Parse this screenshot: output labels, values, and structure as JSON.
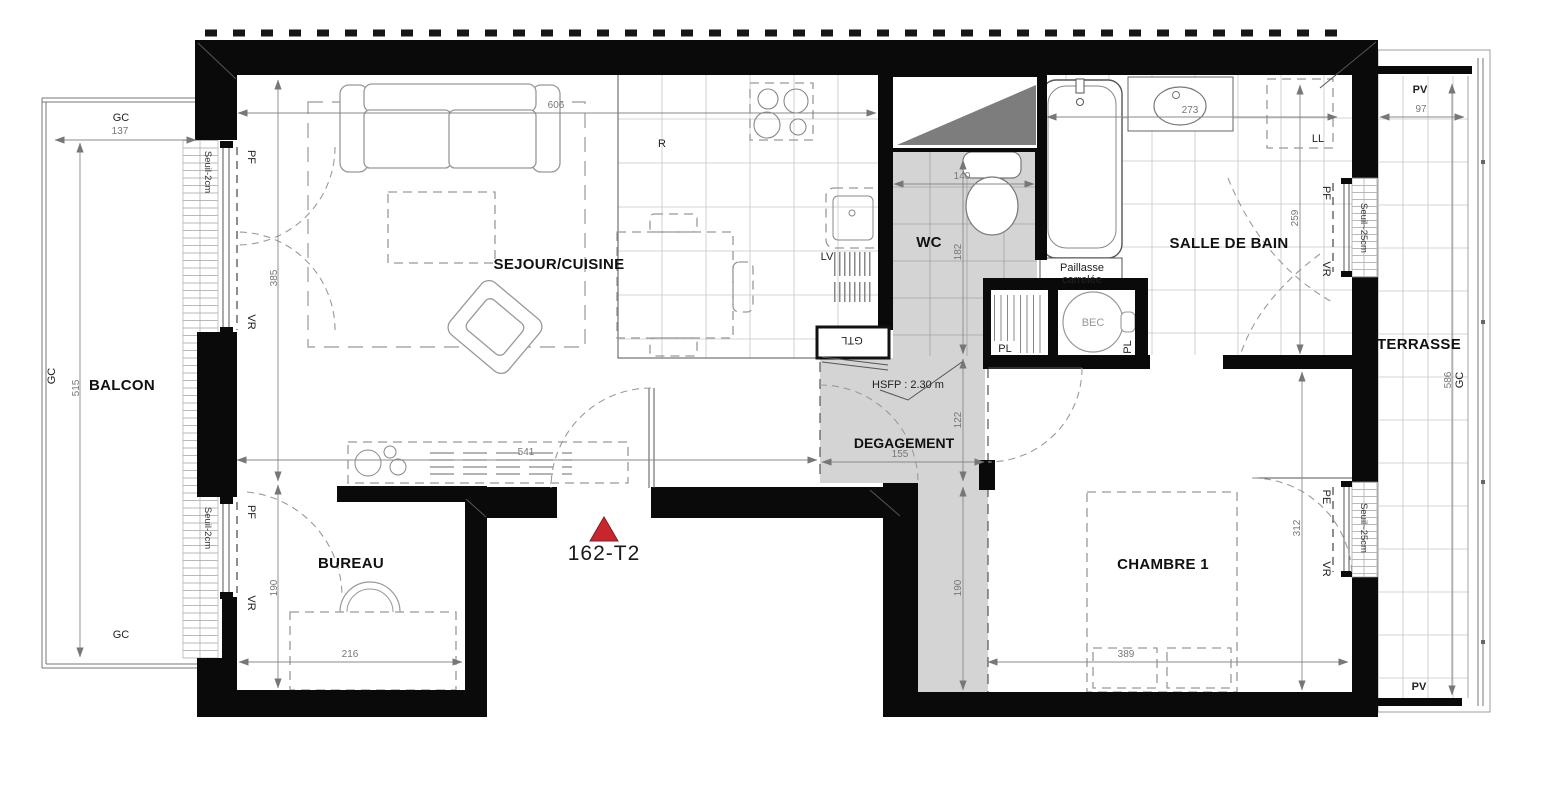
{
  "plan": {
    "unit": "162-T2",
    "rooms": {
      "balcon": "BALCON",
      "sejour": "SEJOUR/CUISINE",
      "bureau": "BUREAU",
      "wc": "WC",
      "bain": "SALLE DE BAIN",
      "terrasse": "TERRASSE",
      "degagement": "DEGAGEMENT",
      "chambre": "CHAMBRE 1"
    },
    "equipment": {
      "gtl": "GTL",
      "bec": "BEC",
      "lv": "LV",
      "ll": "LL",
      "r": "R",
      "pl": "PL",
      "paillasse1": "Paillasse",
      "paillasse2": "carrelée"
    },
    "openings": {
      "pf": "PF",
      "vr": "VR",
      "pe": "PE",
      "pv": "PV",
      "gc": "GC",
      "seuil_2": "Seuil-2cm",
      "seuil_25": "Seuil~25cm"
    },
    "notes": {
      "hsfp": "HSFP : 2.30 m"
    },
    "dims": {
      "balcon_w": "137",
      "balcon_h": "515",
      "sejour_w": "606",
      "sejour_h": "385",
      "sejour_w2": "541",
      "bureau_w": "216",
      "bureau_h": "190",
      "wc_w": "140",
      "wc_h": "182",
      "deg_w": "155",
      "deg_h": "122",
      "couloir_h": "190",
      "bain_w": "273",
      "bain_h": "259",
      "chambre_w": "389",
      "chambre_h": "312",
      "terrasse_w": "97",
      "terrasse_h": "586"
    },
    "colors": {
      "wall": "#0a0a0a",
      "room_gray": "#d4d4d4",
      "marker": "#c9252c"
    }
  }
}
